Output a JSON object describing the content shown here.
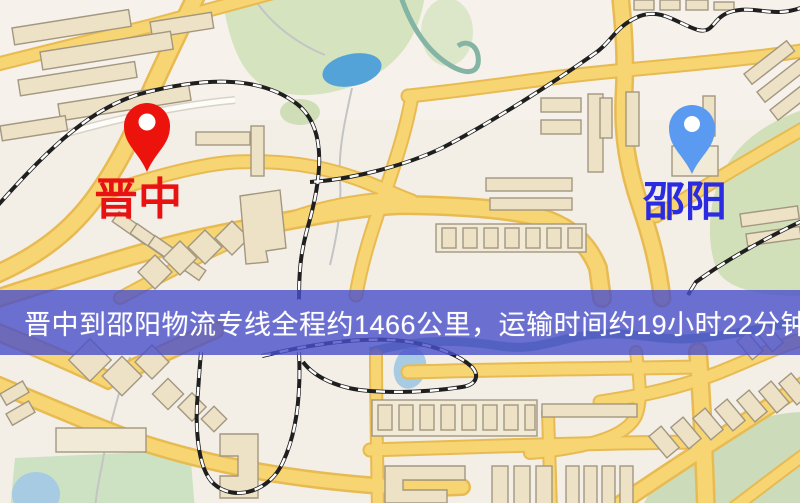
{
  "map": {
    "markers": {
      "origin": {
        "label": "晋中",
        "pin_color": "#ed130d",
        "label_color": "#e81212"
      },
      "destination": {
        "label": "邵阳",
        "pin_color": "#5a9af0",
        "label_color": "#2b2be0"
      }
    },
    "banner": {
      "text": "晋中到邵阳物流专线全程约1466公里，运输时间约19小时22分钟.",
      "background_color": "#494fca",
      "text_color": "#ffffff"
    },
    "palette": {
      "road": "#f7d573",
      "road_casing": "#e8bb52",
      "building": "#ede2c6",
      "park": "#d5e3bf",
      "water": "#54a3d8",
      "railway": "#1f1f1f"
    }
  }
}
